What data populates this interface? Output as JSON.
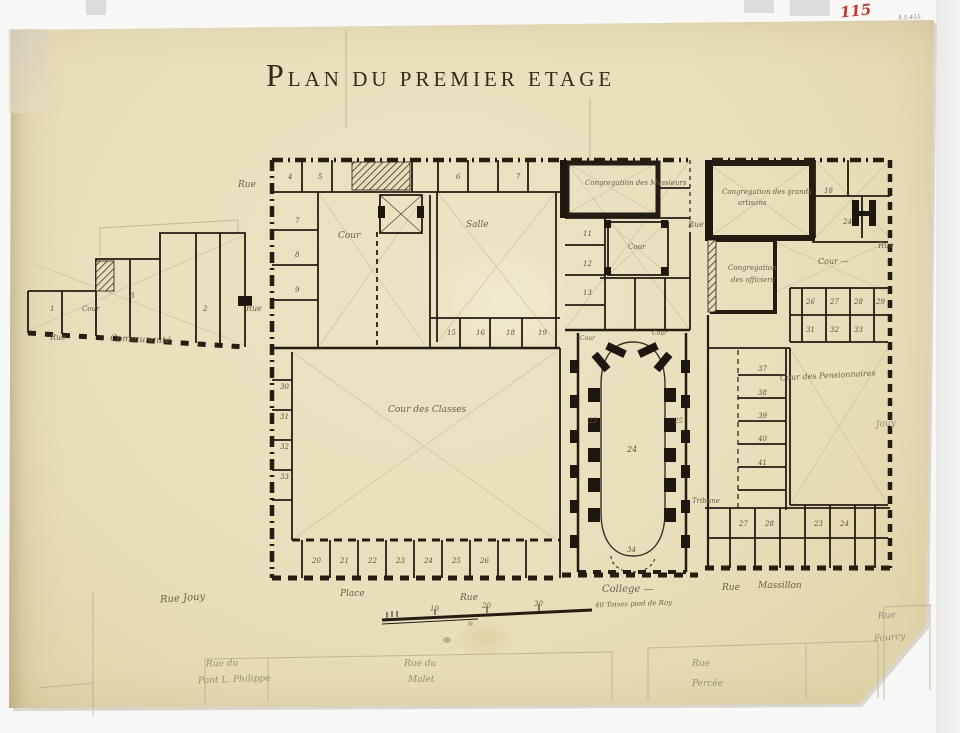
{
  "title": {
    "initial": "P",
    "rest": "lan du premier etage"
  },
  "annotations": {
    "red_number": "115",
    "stamp": "4.5.415"
  },
  "areas": {
    "congregation_messieurs": "Congregation des Messieurs",
    "congregation_artisans_l1": "Congregation des grands",
    "congregation_artisans_l2": "artisans",
    "congregation_officiers_l1": "Congregation",
    "congregation_officiers_l2": "des officiers",
    "cour": "Cour",
    "cour_dash": "Cour —",
    "salle": "Salle",
    "cour_des_classes": "Cour des Classes",
    "cour_des_pensionnaires": "Cour des Pensionnaires",
    "tribune": "Tribune"
  },
  "streets": {
    "rue": "Rue",
    "communaute": "Communauté",
    "rue_jouy": "Rue Jouy",
    "place": "Place",
    "college": "College —",
    "massillon": "Massillon",
    "jouy": "Jouy",
    "pencil_rue_du": "Rue du",
    "pencil_pont_louis_philippe": "Pont L. Philippe",
    "pencil_malet": "Malet",
    "pencil_rue": "Rue",
    "pencil_percee": "Percée",
    "pencil_fourcy": "Fourcy"
  },
  "scale_bar": {
    "ticks": [
      "10",
      "20",
      "30"
    ],
    "end_label": "40 Toises pied de Roy"
  },
  "room_numbers": [
    "1",
    "3",
    "2",
    "7",
    "8",
    "9",
    "4",
    "5",
    "6",
    "7",
    "15",
    "16",
    "18",
    "19",
    "30",
    "31",
    "32",
    "33",
    "20",
    "21",
    "22",
    "23",
    "24",
    "25",
    "26",
    "11",
    "12",
    "13",
    "24",
    "23",
    "25",
    "34",
    "18",
    "24",
    "26",
    "27",
    "28",
    "29",
    "31",
    "32",
    "33",
    "37",
    "38",
    "39",
    "40",
    "41",
    "27",
    "28",
    "23",
    "24"
  ]
}
